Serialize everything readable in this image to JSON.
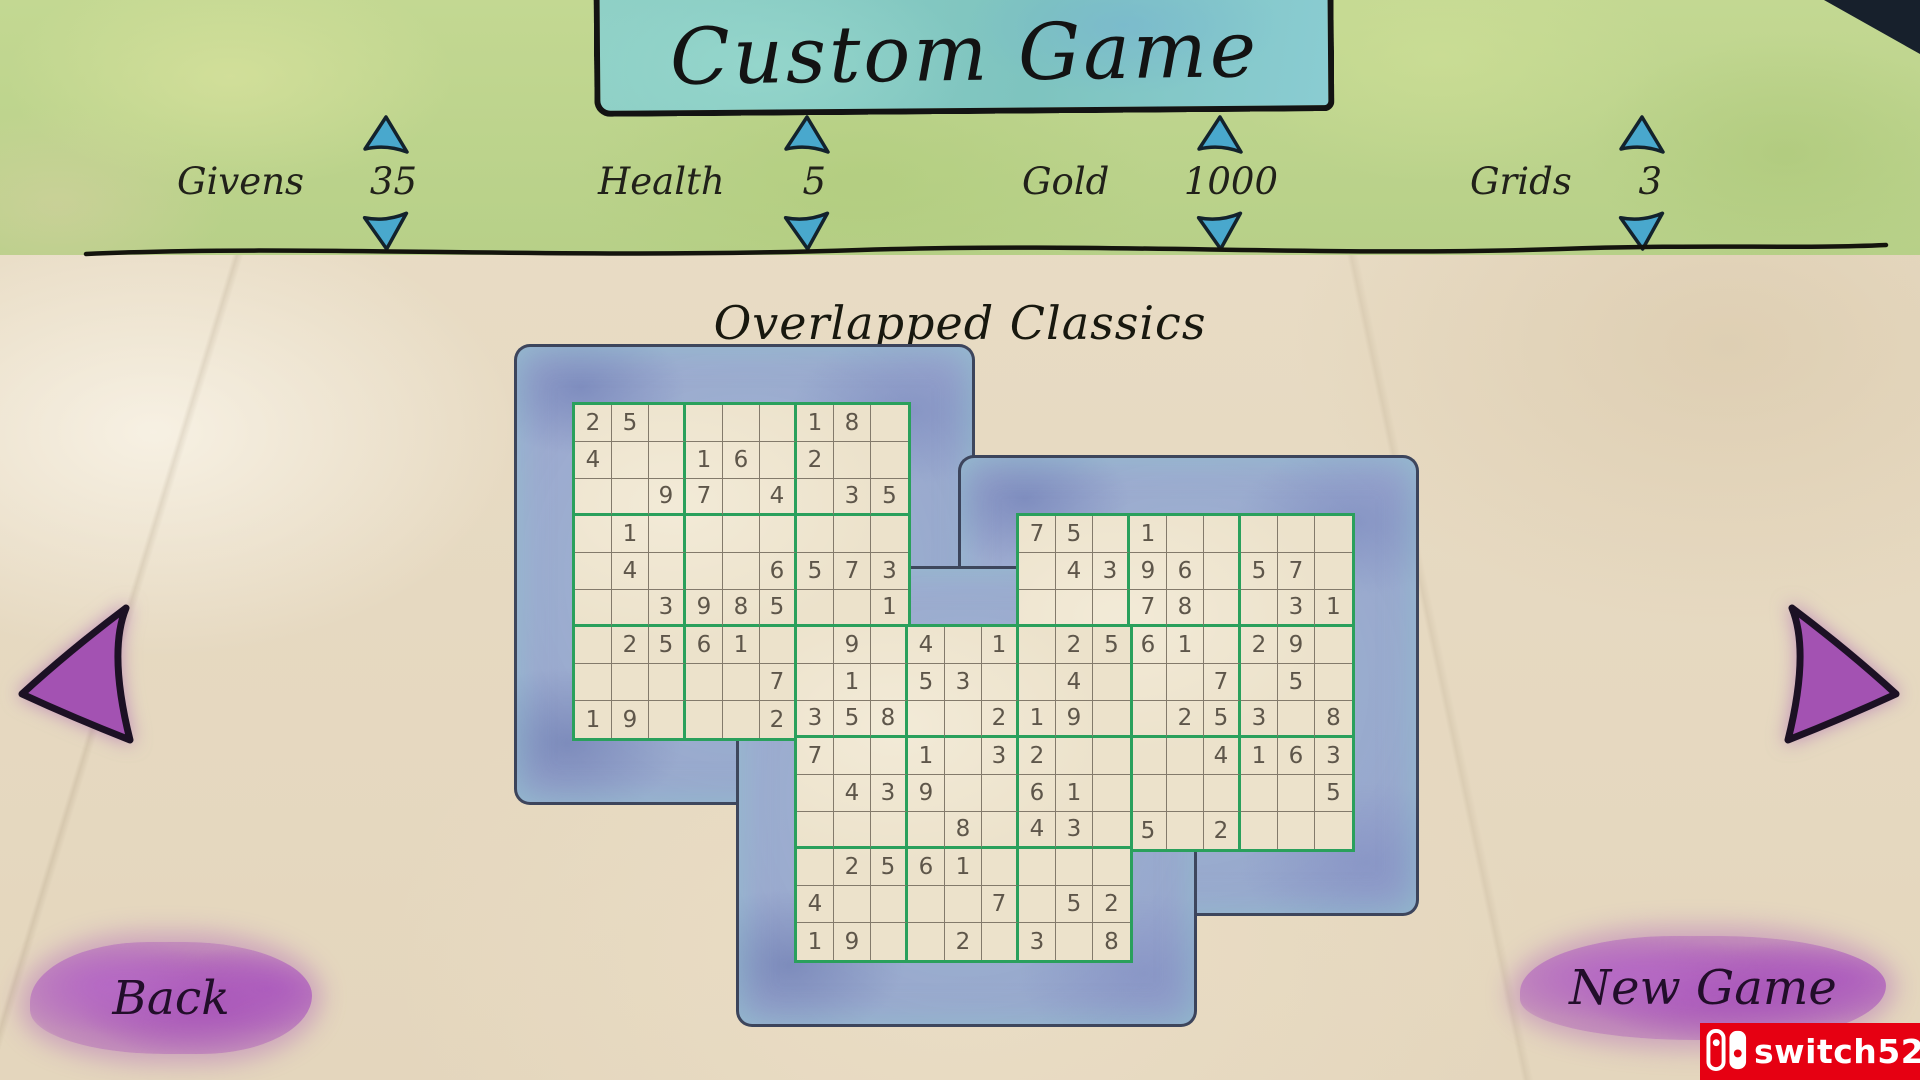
{
  "title": "Custom Game",
  "subtitle": "Overlapped Classics",
  "settings": [
    {
      "label": "Givens",
      "value": "35"
    },
    {
      "label": "Health",
      "value": "5"
    },
    {
      "label": "Gold",
      "value": "1000"
    },
    {
      "label": "Grids",
      "value": "3"
    }
  ],
  "nav": {
    "back": "Back",
    "new_game": "New Game"
  },
  "watermark": {
    "text": "switch520",
    "brand_color": "#e60012"
  },
  "colors": {
    "box_line_green": "#2aa05c",
    "thin_line": "#837a6b",
    "digit": "#5e564a",
    "frame_blue": "#9aa7cf",
    "stepper_blue": "#49a8cd",
    "nav_purple": "#a352b2",
    "button_purple": "#a855b8",
    "watermark_red": "#e60012",
    "banner_teal": "#85c9c3",
    "top_green": "#bdd48d",
    "paper": "#e8dcc5"
  },
  "puzzle": {
    "layout_name": "Overlapped Classics",
    "grid_count": 3,
    "cell_px": 37,
    "grids": [
      {
        "name": "top-left",
        "origin_cell": [
          0,
          0
        ],
        "rows": [
          [
            "2",
            "5",
            "",
            "",
            "",
            "",
            "1",
            "8",
            ""
          ],
          [
            "4",
            "",
            "",
            "1",
            "6",
            "",
            "2",
            "",
            ""
          ],
          [
            "",
            "",
            "9",
            "7",
            "",
            "4",
            "",
            "3",
            "5"
          ],
          [
            "",
            "1",
            "",
            "",
            "",
            "",
            "",
            "",
            ""
          ],
          [
            "",
            "4",
            "",
            "",
            "",
            "6",
            "5",
            "7",
            "3"
          ],
          [
            "",
            "",
            "3",
            "9",
            "8",
            "5",
            "",
            "",
            "1"
          ],
          [
            "",
            "2",
            "5",
            "6",
            "1",
            "",
            "",
            "9",
            ""
          ],
          [
            "",
            "",
            "",
            "",
            "",
            "7",
            "",
            "1",
            ""
          ],
          [
            "1",
            "9",
            "",
            "",
            "",
            "2",
            "3",
            "5",
            "8"
          ]
        ]
      },
      {
        "name": "top-right",
        "origin_cell": [
          12,
          3
        ],
        "rows": [
          [
            "7",
            "5",
            "",
            "1",
            "",
            "",
            "",
            "",
            ""
          ],
          [
            "",
            "4",
            "3",
            "9",
            "6",
            "",
            "5",
            "7",
            ""
          ],
          [
            "",
            "",
            "",
            "7",
            "8",
            "",
            "",
            "3",
            "1"
          ],
          [
            "",
            "2",
            "5",
            "6",
            "1",
            "",
            "2",
            "9",
            ""
          ],
          [
            "",
            "4",
            "",
            "",
            "",
            "7",
            "",
            "5",
            ""
          ],
          [
            "1",
            "9",
            "",
            "",
            "2",
            "5",
            "3",
            "",
            "8"
          ],
          [
            "2",
            "",
            "",
            "",
            "",
            "4",
            "1",
            "6",
            "3"
          ],
          [
            "6",
            "1",
            "",
            "",
            "",
            "",
            "",
            "",
            "5"
          ],
          [
            "4",
            "3",
            "",
            "5",
            "",
            "2",
            "",
            "",
            ""
          ]
        ]
      },
      {
        "name": "bottom-middle",
        "origin_cell": [
          6,
          6
        ],
        "rows": [
          [
            "",
            "9",
            "",
            "4",
            "",
            "1",
            "",
            "2",
            "5"
          ],
          [
            "",
            "1",
            "",
            "5",
            "3",
            "",
            "",
            "4",
            ""
          ],
          [
            "3",
            "5",
            "8",
            "",
            "",
            "2",
            "1",
            "9",
            ""
          ],
          [
            "7",
            "",
            "",
            "1",
            "",
            "3",
            "2",
            "",
            ""
          ],
          [
            "",
            "4",
            "3",
            "9",
            "",
            "",
            "6",
            "1",
            ""
          ],
          [
            "",
            "",
            "",
            "",
            "8",
            "",
            "4",
            "3",
            ""
          ],
          [
            "",
            "2",
            "5",
            "6",
            "1",
            "",
            "",
            "",
            ""
          ],
          [
            "4",
            "",
            "",
            "",
            "",
            "7",
            "",
            "5",
            "2"
          ],
          [
            "1",
            "9",
            "",
            "",
            "2",
            "",
            "3",
            "",
            "8"
          ]
        ]
      }
    ]
  }
}
